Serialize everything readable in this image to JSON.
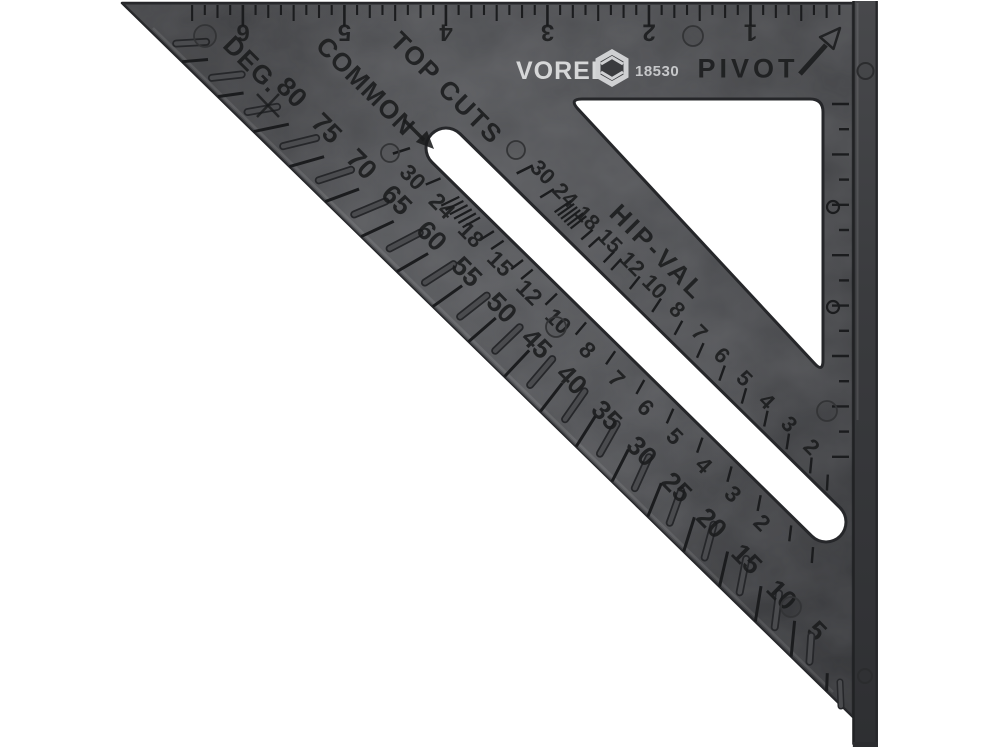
{
  "brand": {
    "name": "VOREL",
    "model": "18530"
  },
  "labels": {
    "pivot": "PIVOT",
    "top_cuts": "TOP CUTS",
    "hip_val": "HIP-VAL",
    "common": "COMMON",
    "degrees": "DEG."
  },
  "scales": {
    "inch_ruler": [
      "1",
      "2",
      "3",
      "4",
      "5",
      "6"
    ],
    "degrees": [
      "80",
      "75",
      "70",
      "65",
      "60",
      "55",
      "50",
      "45",
      "40",
      "35",
      "30",
      "25",
      "20",
      "15",
      "10",
      "5"
    ],
    "common_rafter": [
      "30",
      "24",
      "18",
      "15",
      "12",
      "10",
      "8",
      "7",
      "6",
      "5",
      "4",
      "3",
      "2"
    ],
    "hip_valley_rafter": [
      "30",
      "24",
      "18",
      "15",
      "12",
      "10",
      "8",
      "7",
      "6",
      "5",
      "4",
      "3",
      "2"
    ]
  },
  "colors": {
    "background": "#ffffff",
    "body": "#47484b",
    "body_dark": "#3a3b3e",
    "engraving": "#1a1b1d",
    "fence": "#3a3b3e",
    "logo_text": "#d6d7d8"
  }
}
